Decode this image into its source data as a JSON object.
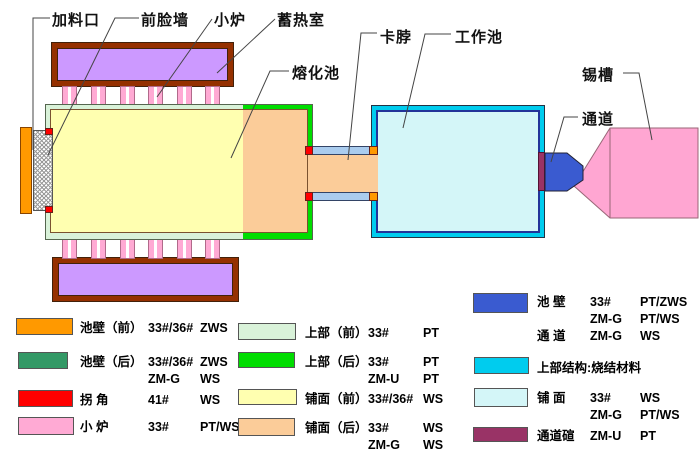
{
  "diagram": {
    "labels": {
      "feed_port": "加料口",
      "front_wall": "前脸墙",
      "port_furnace": "小炉",
      "regenerator": "蓄热室",
      "melting_tank": "熔化池",
      "neck": "卡脖",
      "working_tank": "工作池",
      "tin_bath": "锡槽",
      "channel": "通道"
    }
  },
  "colors": {
    "pool_wall_front": "#ff9900",
    "pool_wall_rear": "#339966",
    "corner": "#ff0000",
    "port_furnace": "#ffaad4",
    "superstructure_front": "#d9f2d9",
    "superstructure_rear": "#00dd00",
    "paving_front": "#ffffb0",
    "paving_rear": "#fbcc99",
    "working_pool_wall": "#3a5bd0",
    "working_superstructure": "#00ccee",
    "working_paving": "#d4f6f8",
    "channel_arch": "#993366",
    "regenerator_fill": "#cc99ff",
    "regenerator_border": "#993300",
    "neck_wall": "#aaccee",
    "working_pool_inner_wall": "#223399",
    "tin_bath": "#ffa6d2"
  },
  "legend": {
    "items": [
      {
        "name": "pool-wall-front",
        "rows": [
          {
            "label": "池壁（前）",
            "a": "33#/36#",
            "b": "ZWS"
          }
        ]
      },
      {
        "name": "pool-wall-rear",
        "rows": [
          {
            "label": "池壁（后）",
            "a": "33#/36#",
            "b": "ZWS"
          },
          {
            "label": "",
            "a": "ZM-G",
            "b": "WS"
          }
        ]
      },
      {
        "name": "corner",
        "rows": [
          {
            "label": "拐 角",
            "a": "41#",
            "b": "WS"
          }
        ]
      },
      {
        "name": "port-furnace",
        "rows": [
          {
            "label": "小 炉",
            "a": "33#",
            "b": "PT/WS"
          }
        ]
      },
      {
        "name": "superstructure-front",
        "rows": [
          {
            "label": "上部（前）",
            "a": "33#",
            "b": "PT"
          }
        ]
      },
      {
        "name": "superstructure-rear",
        "rows": [
          {
            "label": "上部（后）",
            "a": "33#",
            "b": "PT"
          },
          {
            "label": "",
            "a": "ZM-U",
            "b": "PT"
          }
        ]
      },
      {
        "name": "paving-front",
        "rows": [
          {
            "label": "铺面（前）",
            "a": "33#/36#",
            "b": "WS"
          }
        ]
      },
      {
        "name": "paving-rear",
        "rows": [
          {
            "label": "铺面（后）",
            "a": "33#",
            "b": "WS"
          },
          {
            "label": "",
            "a": "ZM-G",
            "b": "WS"
          }
        ]
      },
      {
        "name": "working-pool-wall",
        "rows": [
          {
            "label": "池 壁",
            "a": "33#",
            "b": "PT/ZWS"
          },
          {
            "label": "",
            "a": "ZM-G",
            "b": "PT/WS"
          },
          {
            "label": "通 道",
            "a": "ZM-G",
            "b": "WS"
          }
        ]
      },
      {
        "name": "working-superstructure",
        "rows": [
          {
            "label": "上部结构:",
            "a": "烧结材料",
            "b": ""
          }
        ]
      },
      {
        "name": "working-paving",
        "rows": [
          {
            "label": "铺 面",
            "a": "33#",
            "b": "WS"
          },
          {
            "label": "",
            "a": "ZM-G",
            "b": "PT/WS"
          }
        ]
      },
      {
        "name": "channel-arch",
        "rows": [
          {
            "label": "通道碹",
            "a": "ZM-U",
            "b": "PT"
          }
        ]
      }
    ]
  }
}
